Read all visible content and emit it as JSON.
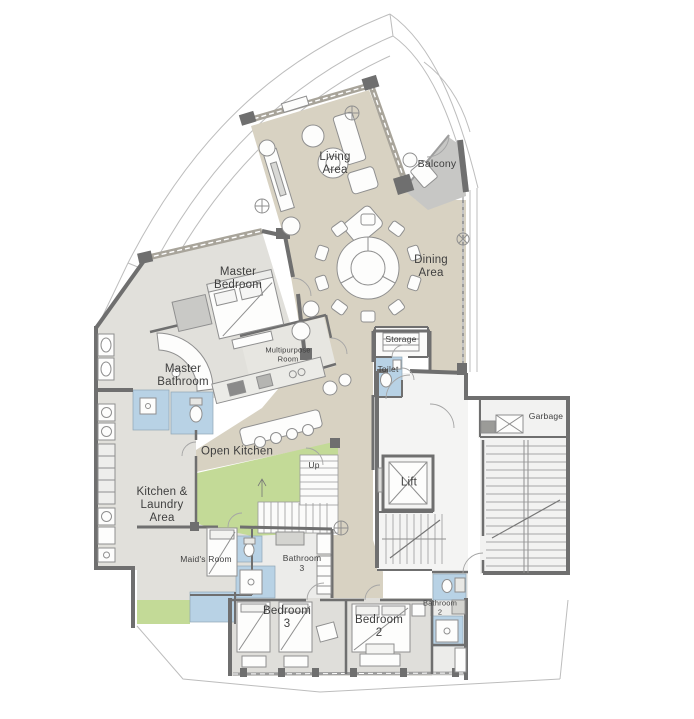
{
  "plan": {
    "type": "apartment-floor-plan",
    "rooms": [
      {
        "id": "living-area",
        "label": "Living\nArea"
      },
      {
        "id": "balcony",
        "label": "Balcony"
      },
      {
        "id": "dining-area",
        "label": "Dining\nArea"
      },
      {
        "id": "master-bedroom",
        "label": "Master\nBedroom"
      },
      {
        "id": "multipurpose-room",
        "label": "Multipurpose\nRoom"
      },
      {
        "id": "master-bathroom",
        "label": "Master\nBathroom"
      },
      {
        "id": "storage",
        "label": "Storage"
      },
      {
        "id": "toilet",
        "label": "Toilet"
      },
      {
        "id": "garbage",
        "label": "Garbage"
      },
      {
        "id": "open-kitchen",
        "label": "Open Kitchen"
      },
      {
        "id": "up",
        "label": "Up"
      },
      {
        "id": "lift",
        "label": "Lift"
      },
      {
        "id": "kitchen-laundry",
        "label": "Kitchen &\nLaundry\nArea"
      },
      {
        "id": "maids-room",
        "label": "Maid's Room"
      },
      {
        "id": "bathroom-3",
        "label": "Bathroom\n3"
      },
      {
        "id": "bedroom-3",
        "label": "Bedroom\n3"
      },
      {
        "id": "bedroom-2",
        "label": "Bedroom\n2"
      },
      {
        "id": "bathroom-2",
        "label": "Bathroom\n2"
      }
    ],
    "colors": {
      "floor_beige": "#d8d2c2",
      "room_gray": "#e1e0db",
      "bathroom_blue": "#b8d2e5",
      "stair_green": "#c3da97",
      "balcony_gray": "#c7c7c5",
      "wall_dark": "#6f6f6f",
      "outline_gray": "#bdbdbd",
      "label_text": "#3f3f3f"
    }
  }
}
